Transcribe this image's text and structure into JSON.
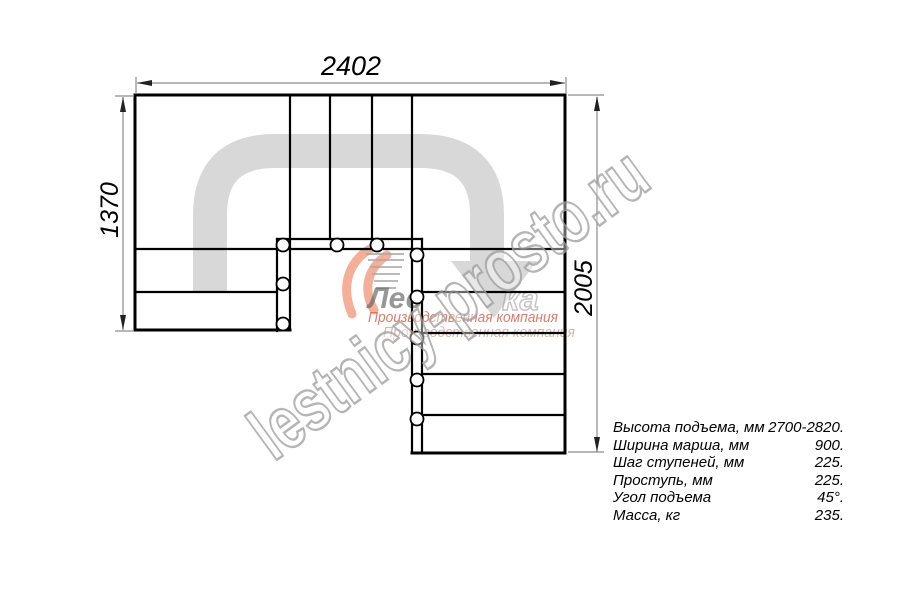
{
  "drawing": {
    "title": "staircase-plan-top-view",
    "dim_width_top": "2402",
    "dim_height_left": "1370",
    "dim_height_right": "2005"
  },
  "specs": {
    "rows": [
      {
        "label": "Высота подъема, мм",
        "value": "2700-2820."
      },
      {
        "label": "Ширина марша, мм",
        "value": "900."
      },
      {
        "label": "Шаг ступеней, мм",
        "value": "225."
      },
      {
        "label": "Проступь, мм",
        "value": "225."
      },
      {
        "label": "Угол подъема",
        "value": "45°."
      },
      {
        "label": "Масса, кг",
        "value": "235."
      }
    ]
  },
  "watermark": {
    "site": "lestnicy-prosto.ru",
    "logo_fragment": "Лес",
    "logo_fragment2": "ка",
    "tagline": "Производственная компания",
    "tagline2": "Производственная компания"
  },
  "colors": {
    "plan_line": "#000000",
    "dimension_line": "#8c8c8c",
    "flow_arrow": "#d8d8d8",
    "logo_flame": "#f2a285",
    "logo_tagline": "#d9705c",
    "watermark_outline": "#a3a3a3"
  }
}
